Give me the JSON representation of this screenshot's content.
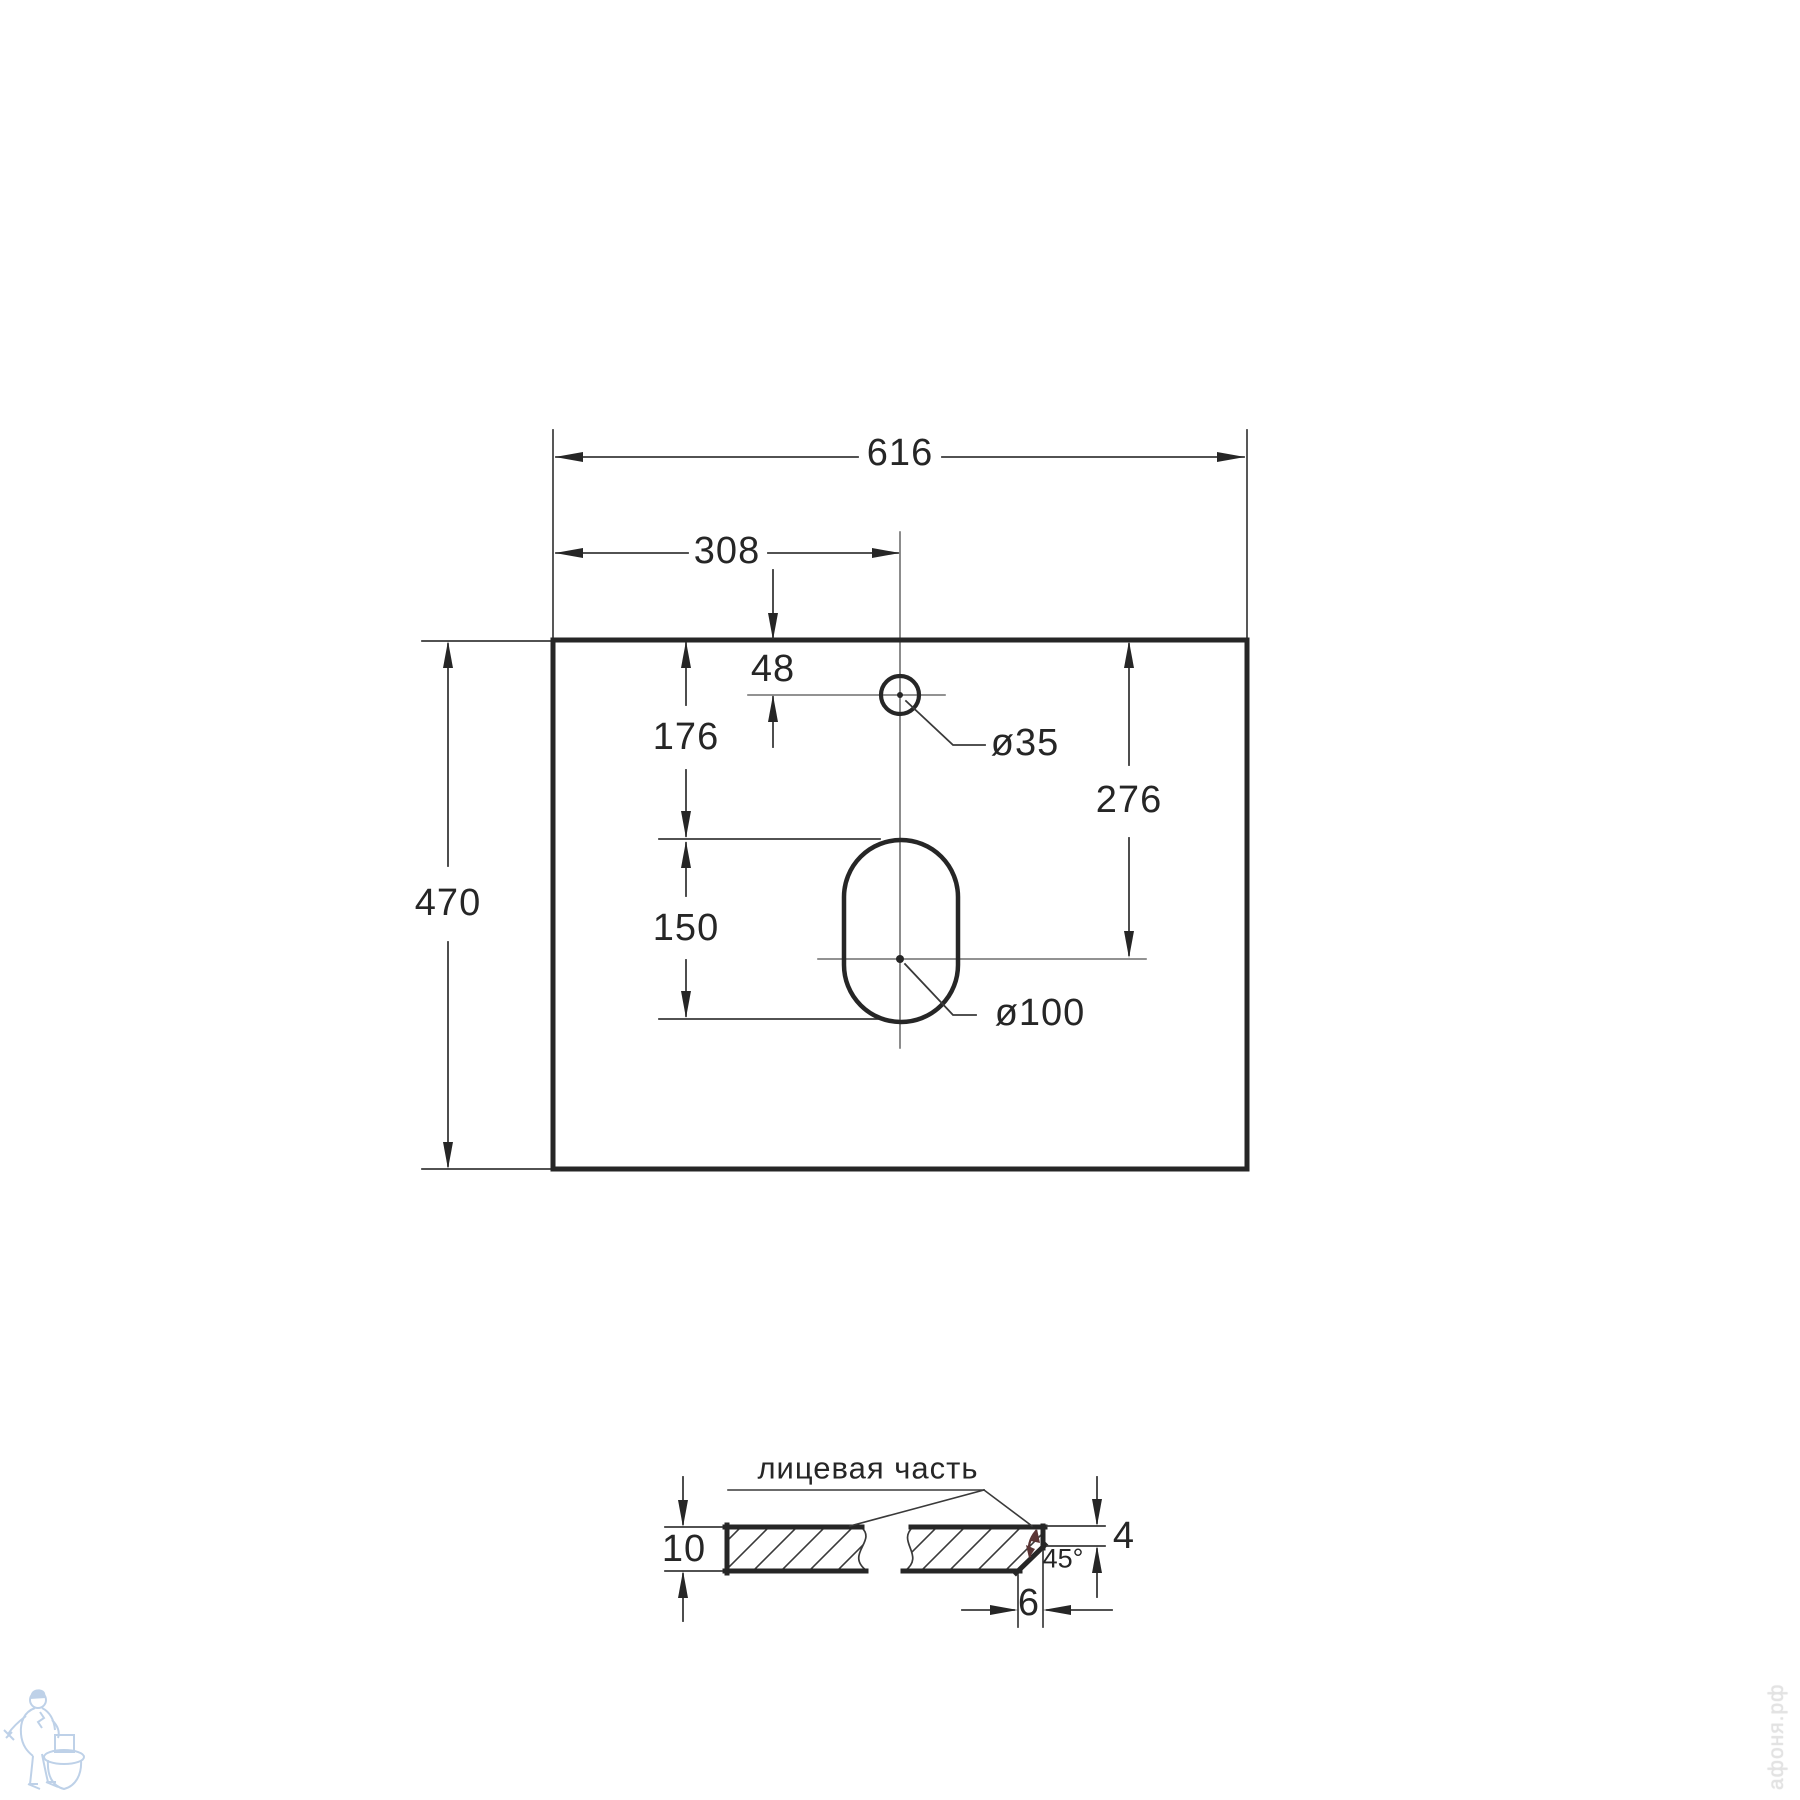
{
  "drawing": {
    "top_view": {
      "overall_width_label": "616",
      "center_offset_label": "308",
      "faucet_edge_offset_label": "48",
      "faucet_hole_diameter_label": "ø35",
      "drain_top_offset_label": "176",
      "drain_slot_length_label": "150",
      "overall_depth_label": "470",
      "drain_center_offset_label": "276",
      "drain_hole_diameter_label": "ø100"
    },
    "section_view": {
      "face_side_label": "лицевая часть",
      "thickness_label": "10",
      "chamfer_height_label": "4",
      "chamfer_angle_label": "45°",
      "chamfer_width_label": "6"
    },
    "watermark": {
      "site_text": "афоня.рф"
    },
    "colors": {
      "line_ink": "#262626",
      "thin_line": "#3a3a3a",
      "center_line_gray": "#6f6f6f",
      "angle_arc_accent": "#5a3434",
      "watermark_blue": "#b7cde6"
    }
  }
}
